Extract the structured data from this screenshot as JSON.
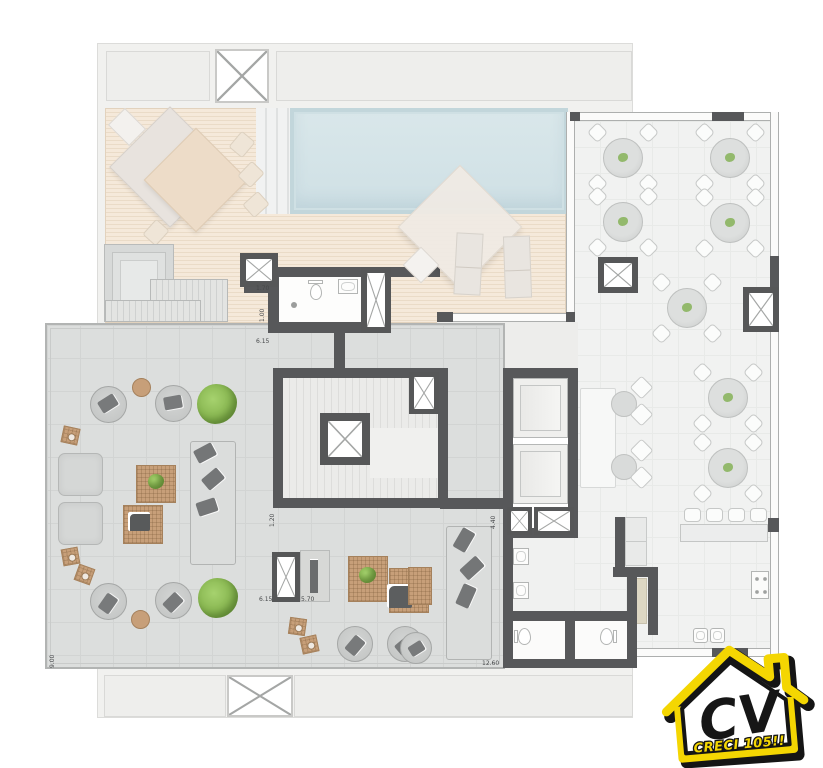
{
  "plan": {
    "dimensions": [
      {
        "text": "1.70",
        "orientation": "horizontal"
      },
      {
        "text": "1.00",
        "orientation": "vertical"
      },
      {
        "text": "6.15",
        "orientation": "horizontal"
      },
      {
        "text": "1.20",
        "orientation": "vertical"
      },
      {
        "text": "4.40",
        "orientation": "vertical"
      },
      {
        "text": "6.15",
        "orientation": "horizontal"
      },
      {
        "text": "5.70",
        "orientation": "horizontal"
      },
      {
        "text": "9.00",
        "orientation": "vertical"
      },
      {
        "text": "12.60",
        "orientation": "horizontal"
      }
    ],
    "colors": {
      "wall": "#57585a",
      "deck_wood": "#f2e5d4",
      "pool_water": "#d6e5e9",
      "terrace_floor": "#dcdedd",
      "interior_floor": "#f1f2f1",
      "wicker": "#c79f79",
      "plant_green": "#8abc55",
      "logo_yellow": "#f4d602"
    }
  },
  "logo": {
    "monogram": "CV",
    "caption": "CRECI 105!!"
  }
}
